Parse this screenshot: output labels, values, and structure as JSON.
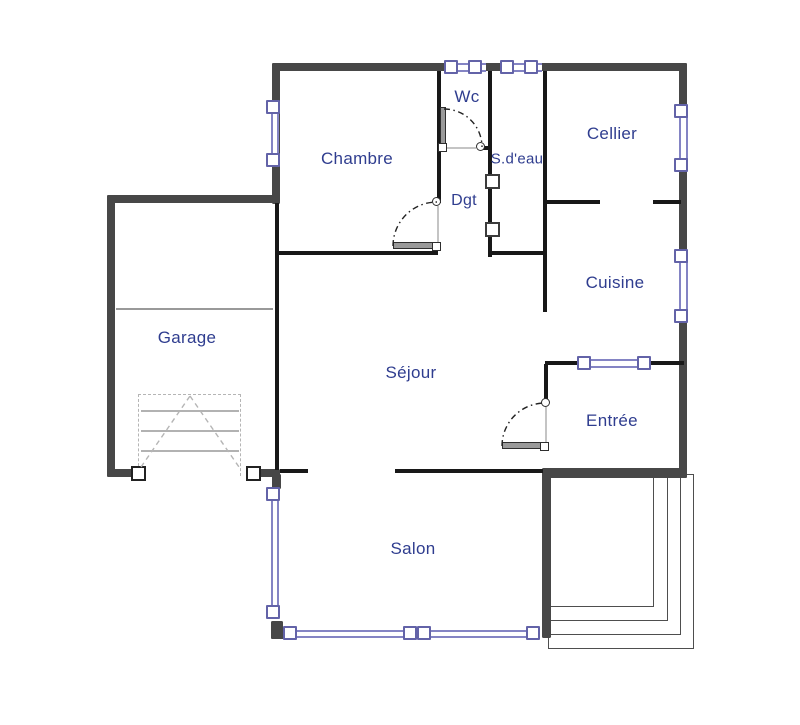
{
  "canvas": {
    "w": 800,
    "h": 725,
    "background": "#ffffff"
  },
  "colors": {
    "exterior_wall": "#474747",
    "interior_wall": "#181818",
    "window_frame": "#6363a8",
    "window_glass_line": "#8484c4",
    "label_text": "#2f3d8f",
    "door_leaf": "#9a9a9a",
    "garage_door_dash": "#b5b5b5",
    "terrace_line": "#4e4e4e"
  },
  "rooms": [
    {
      "id": "chambre",
      "label": "Chambre",
      "cx": 357,
      "cy": 159,
      "size": 17
    },
    {
      "id": "wc",
      "label": "Wc",
      "cx": 467,
      "cy": 97,
      "size": 17
    },
    {
      "id": "sdeau",
      "label": "S.d'eau",
      "cx": 517,
      "cy": 159,
      "size": 15
    },
    {
      "id": "cellier",
      "label": "Cellier",
      "cx": 612,
      "cy": 134,
      "size": 17
    },
    {
      "id": "dgt",
      "label": "Dgt",
      "cx": 464,
      "cy": 201,
      "size": 16
    },
    {
      "id": "cuisine",
      "label": "Cuisine",
      "cx": 615,
      "cy": 283,
      "size": 17
    },
    {
      "id": "garage",
      "label": "Garage",
      "cx": 187,
      "cy": 338,
      "size": 17
    },
    {
      "id": "sejour",
      "label": "Séjour",
      "cx": 411,
      "cy": 373,
      "size": 17
    },
    {
      "id": "entree",
      "label": "Entrée",
      "cx": 612,
      "cy": 421,
      "size": 17
    },
    {
      "id": "salon",
      "label": "Salon",
      "cx": 413,
      "cy": 549,
      "size": 17
    }
  ],
  "walls_ext": [
    {
      "id": "top",
      "x": 272,
      "y": 63,
      "w": 415,
      "h": 8
    },
    {
      "id": "left-upper",
      "x": 272,
      "y": 63,
      "w": 8,
      "h": 141
    },
    {
      "id": "right",
      "x": 679,
      "y": 63,
      "w": 8,
      "h": 415
    },
    {
      "id": "garage-top",
      "x": 107,
      "y": 195,
      "w": 173,
      "h": 8
    },
    {
      "id": "garage-left",
      "x": 107,
      "y": 195,
      "w": 8,
      "h": 282
    },
    {
      "id": "garage-bottom-left",
      "x": 107,
      "y": 469,
      "w": 28,
      "h": 8
    },
    {
      "id": "garage-bottom-right",
      "x": 258,
      "y": 469,
      "w": 22,
      "h": 8
    },
    {
      "id": "entree-bottom",
      "x": 543,
      "y": 468,
      "w": 144,
      "h": 10
    },
    {
      "id": "salon-east",
      "x": 542,
      "y": 468,
      "w": 9,
      "h": 170
    },
    {
      "id": "salon-west-stub",
      "x": 272,
      "y": 474,
      "w": 9,
      "h": 15
    },
    {
      "id": "salon-sw-corner-v",
      "x": 271,
      "y": 621,
      "w": 12,
      "h": 18
    },
    {
      "id": "salon-sw-corner-h",
      "x": 271,
      "y": 630,
      "w": 19,
      "h": 9
    }
  ],
  "walls_int": [
    {
      "id": "sejour-west",
      "x": 275,
      "y": 203,
      "w": 4,
      "h": 267
    },
    {
      "id": "chambre-bottom",
      "x": 278,
      "y": 251,
      "w": 160,
      "h": 4
    },
    {
      "id": "chambre-east",
      "x": 437,
      "y": 71,
      "w": 4,
      "h": 132
    },
    {
      "id": "sdeau-west",
      "x": 488,
      "y": 71,
      "w": 4,
      "h": 186
    },
    {
      "id": "sdeau-bottom",
      "x": 488,
      "y": 251,
      "w": 58,
      "h": 4
    },
    {
      "id": "cuisine-west",
      "x": 543,
      "y": 71,
      "w": 4,
      "h": 241
    },
    {
      "id": "cellier-cuisine-a",
      "x": 547,
      "y": 200,
      "w": 53,
      "h": 4
    },
    {
      "id": "cellier-cuisine-b",
      "x": 653,
      "y": 200,
      "w": 28,
      "h": 4
    },
    {
      "id": "entree-top",
      "x": 545,
      "y": 361,
      "w": 139,
      "h": 4
    },
    {
      "id": "entree-west",
      "x": 544,
      "y": 364,
      "w": 4,
      "h": 37
    },
    {
      "id": "sejour-salon-stub",
      "x": 280,
      "y": 469,
      "w": 28,
      "h": 4
    },
    {
      "id": "sejour-salon-main",
      "x": 395,
      "y": 469,
      "w": 148,
      "h": 4
    },
    {
      "id": "wc-strike-stub",
      "x": 481,
      "y": 146,
      "w": 9,
      "h": 4
    }
  ],
  "thin_lines": [
    {
      "id": "garage-inner",
      "x": 116,
      "y": 308,
      "w": 157,
      "h": 2,
      "c": "#999999"
    }
  ],
  "windows": {
    "connectors": [
      {
        "x": 448,
        "y": 62.5,
        "w": 38,
        "h": 9
      },
      {
        "x": 504,
        "y": 62.5,
        "w": 38,
        "h": 9
      },
      {
        "x": 581,
        "y": 358.5,
        "w": 62,
        "h": 9
      },
      {
        "x": 287,
        "y": 629.5,
        "w": 122,
        "h": 8
      },
      {
        "x": 424,
        "y": 629.5,
        "w": 108,
        "h": 8
      },
      {
        "x": 271,
        "y": 104,
        "w": 8,
        "h": 55
      },
      {
        "x": 678.5,
        "y": 108,
        "w": 9,
        "h": 56
      },
      {
        "x": 678.5,
        "y": 253,
        "w": 9,
        "h": 62
      },
      {
        "x": 271,
        "y": 491,
        "w": 8,
        "h": 120
      }
    ],
    "squares": [
      {
        "x": 444,
        "y": 60
      },
      {
        "x": 468,
        "y": 60
      },
      {
        "x": 500,
        "y": 60
      },
      {
        "x": 524,
        "y": 60
      },
      {
        "x": 266,
        "y": 100
      },
      {
        "x": 266,
        "y": 153
      },
      {
        "x": 674,
        "y": 104
      },
      {
        "x": 674,
        "y": 158
      },
      {
        "x": 674,
        "y": 249
      },
      {
        "x": 674,
        "y": 309
      },
      {
        "x": 577,
        "y": 356
      },
      {
        "x": 637,
        "y": 356
      },
      {
        "x": 266,
        "y": 487
      },
      {
        "x": 266,
        "y": 605
      },
      {
        "x": 283,
        "y": 626
      },
      {
        "x": 403,
        "y": 626
      },
      {
        "x": 417,
        "y": 626
      },
      {
        "x": 526,
        "y": 626
      }
    ],
    "square_size": 14
  },
  "partition_squares": [
    {
      "x": 485,
      "y": 174
    },
    {
      "x": 485,
      "y": 222
    }
  ],
  "pillars": [
    {
      "x": 131,
      "y": 466
    },
    {
      "x": 246,
      "y": 466
    }
  ],
  "doors": {
    "leaves": [
      {
        "id": "wc-leaf",
        "x": 440,
        "y": 107,
        "w": 6,
        "h": 40
      },
      {
        "id": "chambre-leaf",
        "x": 393,
        "y": 242,
        "w": 44,
        "h": 7
      },
      {
        "id": "entree-leaf",
        "x": 502,
        "y": 442,
        "w": 40,
        "h": 7
      }
    ],
    "pivots": [
      {
        "x": 438,
        "y": 143
      },
      {
        "x": 432,
        "y": 242
      },
      {
        "x": 540,
        "y": 442
      }
    ],
    "strikes": [
      {
        "x": 476,
        "y": 142
      },
      {
        "x": 432,
        "y": 197
      },
      {
        "x": 541,
        "y": 398
      }
    ],
    "frames": [
      {
        "x": 447,
        "y": 147,
        "w": 29,
        "h": 1.5
      },
      {
        "x": 437,
        "y": 206,
        "w": 1.5,
        "h": 36
      },
      {
        "x": 545,
        "y": 407,
        "w": 1.5,
        "h": 35
      }
    ],
    "arcs": [
      "M444,109 A38,38 0 0 1 482,147",
      "M393,246 A44,44 0 0 1 437,202",
      "M502,446 A43,43 0 0 1 545,403"
    ]
  },
  "terrace_rects": [
    {
      "x": 548,
      "y": 474,
      "w": 106,
      "h": 133
    },
    {
      "x": 548,
      "y": 474,
      "w": 120,
      "h": 147
    },
    {
      "x": 548,
      "y": 474,
      "w": 133,
      "h": 161
    },
    {
      "x": 548,
      "y": 474,
      "w": 146,
      "h": 175
    }
  ],
  "garage_door": {
    "rect": {
      "x": 138,
      "y": 394,
      "w": 103,
      "h": 82
    },
    "hlines": [
      {
        "x": 141,
        "y": 410,
        "w": 98,
        "h": 1.5
      },
      {
        "x": 141,
        "y": 430,
        "w": 98,
        "h": 1.5
      },
      {
        "x": 141,
        "y": 450,
        "w": 98,
        "h": 1.5
      }
    ],
    "diagonals": [
      "M141,467 L190,396",
      "M190,396 L239,467"
    ]
  }
}
